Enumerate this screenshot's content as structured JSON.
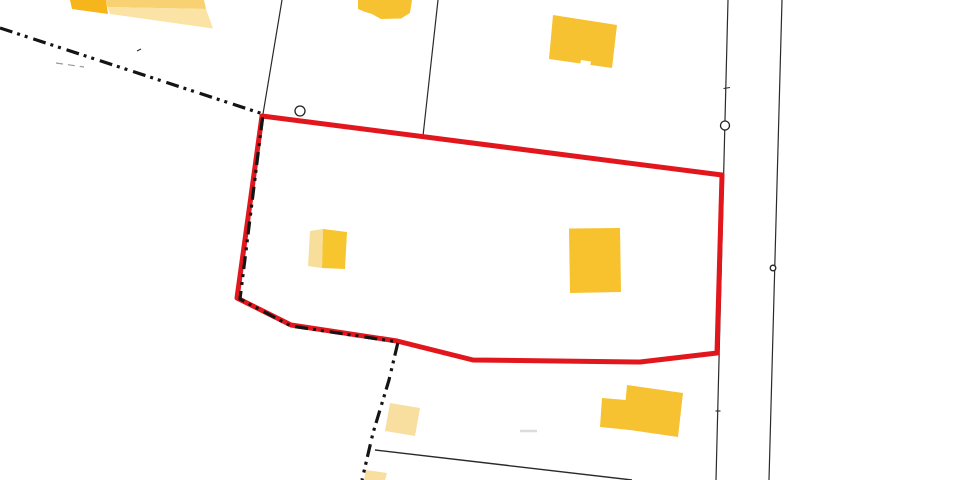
{
  "map": {
    "background_color": "#ffffff",
    "palette": {
      "selection_red": "#E2171E",
      "building_yellow": "#F7C22F",
      "building_pale_yellow": "#F8DFA0",
      "building_dark_yellow": "#F5B51B",
      "building_mid_yellow": "#F7D172",
      "line_black": "#2A2A2A",
      "boundary_black": "#141414",
      "faint_gray": "#9A9A9A",
      "smudge_gray": "#DCDCDC",
      "white": "#FFFFFF"
    },
    "selected_parcel": {
      "points": "262,116 722,175 718,317 717,353 640,362 473,360 397,341 291,325 237,298",
      "color": "#E2171E",
      "width": 5
    },
    "boundary_line": {
      "points": "0,28 263,114 240,299 291,326 398,342 389,380 373,433 362,480",
      "color": "#141414",
      "width": 3.2,
      "dash": "13 5 3 5 3 6"
    },
    "parcel_lines": [
      {
        "x1": 282,
        "y1": 0,
        "x2": 263,
        "y2": 114
      },
      {
        "x1": 438,
        "y1": 0,
        "x2": 423,
        "y2": 136
      },
      {
        "x1": 728,
        "y1": 0,
        "x2": 716,
        "y2": 480
      },
      {
        "x1": 782,
        "y1": 0,
        "x2": 769,
        "y2": 480
      },
      {
        "x1": 375,
        "y1": 450,
        "x2": 632,
        "y2": 480
      }
    ],
    "buildings": [
      {
        "id": "b1-dark",
        "fill": "#F5B51B",
        "points": "70,0 106,0 108,14 72,9"
      },
      {
        "id": "b1-mid",
        "fill": "#F7D172",
        "points": "106,0 204,0 206,9 107.5,7"
      },
      {
        "id": "b1-pale",
        "fill": "#FAE3A4",
        "points": "107.5,7 206,9 213,28.5 110,14"
      },
      {
        "id": "b2",
        "fill": "#F7C231",
        "points": "358,0 412,0 410,13 401,18.5 381,19 372,14 364,11.5 358,9"
      },
      {
        "id": "b3",
        "fill": "#F7C231",
        "points": "553,15 617,25 612,68 549,59"
      },
      {
        "id": "b3-notch",
        "fill": "#FFFFFF",
        "points": "581,60 591,61.5 590,66.5 580,65"
      },
      {
        "id": "b4-pale",
        "fill": "#F8DE9B",
        "points": "310,231 323,229 322,268 308,266"
      },
      {
        "id": "b4-dark",
        "fill": "#F7C52E",
        "points": "323,229 347,232 345,269 322,268"
      },
      {
        "id": "b5",
        "fill": "#F7C22E",
        "points": "569,228.5 620,228 621,292 570,293"
      },
      {
        "id": "b6-main",
        "fill": "#F7C231",
        "points": "627,385 683,393 678,437 623,429"
      },
      {
        "id": "b6-ext",
        "fill": "#F7C231",
        "points": "602,398 632,400.5 630,430 600,427"
      },
      {
        "id": "b7-pale",
        "fill": "#F8DFA0",
        "points": "390,403 420,408 415,436 385,431"
      },
      {
        "id": "b8-pale",
        "fill": "#F8DFA0",
        "points": "366,470 387,473 385,480 364,480"
      }
    ],
    "markers": [
      {
        "cx": 300,
        "cy": 111,
        "r": 5,
        "stroke": "#222222",
        "fill": "#FFFFFF"
      },
      {
        "cx": 725,
        "cy": 125.5,
        "r": 4.5,
        "stroke": "#222222",
        "fill": "#FFFFFF"
      },
      {
        "cx": 773,
        "cy": 268,
        "r": 2.8,
        "stroke": "#222222",
        "fill": "#FFFFFF"
      }
    ],
    "tick_marks": [
      {
        "x1": 723.5,
        "y1": 88.5,
        "x2": 730,
        "y2": 87.5
      },
      {
        "x1": 715.5,
        "y1": 411,
        "x2": 720.5,
        "y2": 411
      },
      {
        "x1": 137,
        "y1": 51,
        "x2": 141,
        "y2": 49
      }
    ],
    "faint_marks": {
      "dash_segment": {
        "x1": 56,
        "y1": 63,
        "x2": 84,
        "y2": 67,
        "stroke": "#9A9A9A",
        "dash": "7 5",
        "width": 1.2
      },
      "smudge": {
        "x1": 520,
        "y1": 431,
        "x2": 537,
        "y2": 431,
        "stroke": "#DCDCDC",
        "dash": "",
        "width": 2.5
      },
      "dot": {
        "cx": 748,
        "cy": 148,
        "r": 1.4,
        "fill": "#CFCFCF"
      }
    }
  }
}
